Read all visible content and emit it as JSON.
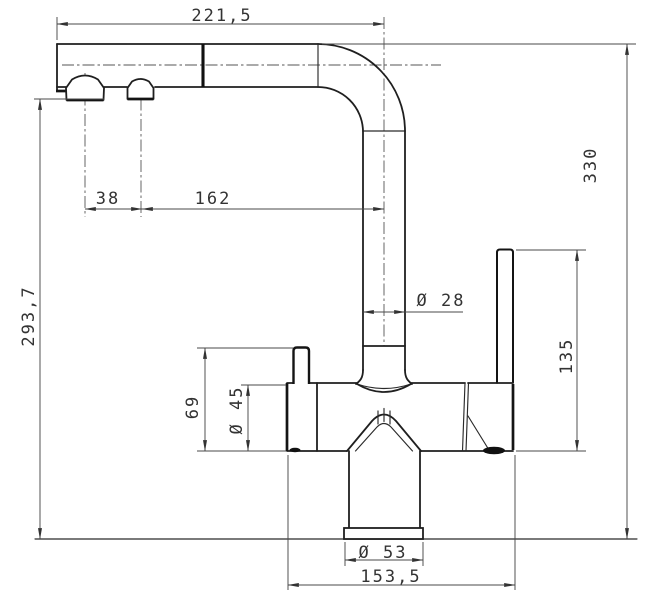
{
  "drawing": {
    "dimensions": {
      "spout_length": "221,5",
      "aerator_spacing": "38",
      "spout_reach": "162",
      "height_to_spout": "293,7",
      "pipe_diameter": "Ø 28",
      "overall_height": "330",
      "lever_height": "135",
      "knob_top_height": "69",
      "body_diameter": "Ø 45",
      "base_plate_diameter": "Ø 53",
      "footprint_width": "153,5"
    }
  }
}
